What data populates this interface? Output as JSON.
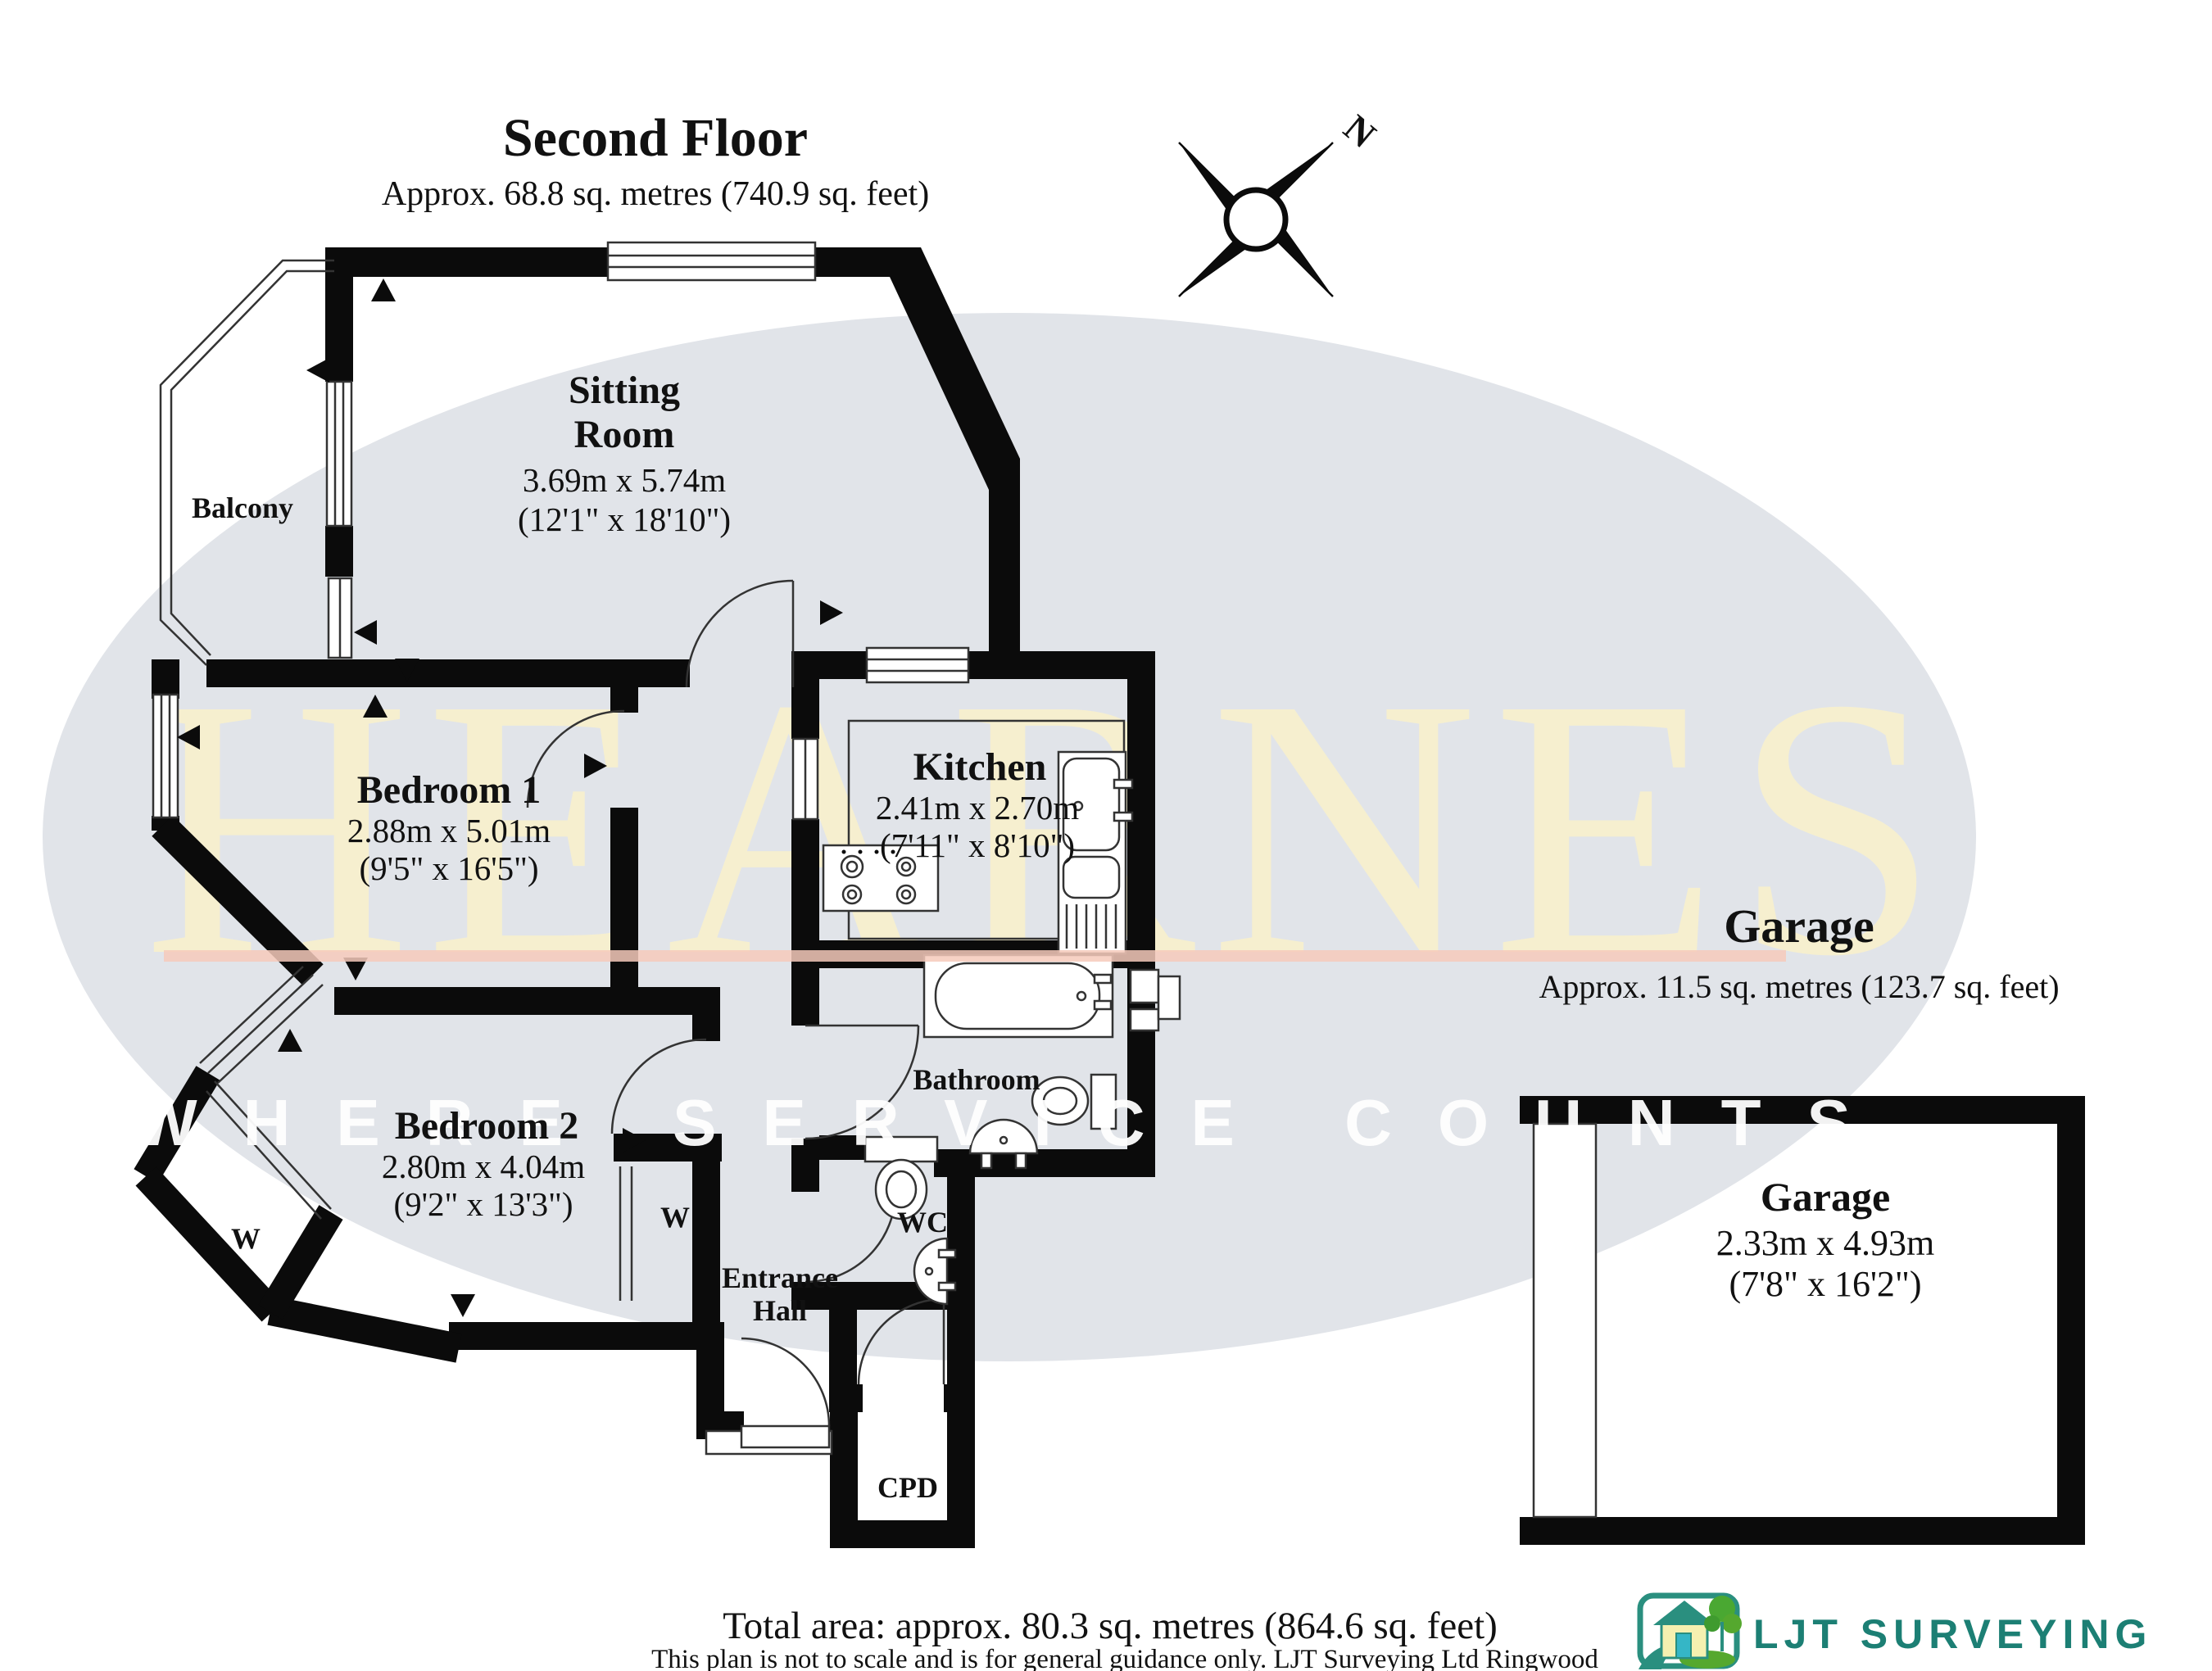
{
  "plan": {
    "title": "Second Floor",
    "subtitle": "Approx. 68.8 sq. metres (740.9 sq. feet)"
  },
  "compass": {
    "north": "N"
  },
  "rooms": {
    "sitting": {
      "line1": "Sitting",
      "line2": "Room",
      "dim_m": "3.69m x 5.74m",
      "dim_ft": "(12'1\" x 18'10\")"
    },
    "balcony": {
      "name": "Balcony"
    },
    "bedroom1": {
      "name": "Bedroom 1",
      "dim_m": "2.88m x 5.01m",
      "dim_ft": "(9'5\" x 16'5\")"
    },
    "kitchen": {
      "name": "Kitchen",
      "dim_m": "2.41m x 2.70m",
      "dim_ft": "(7'11\" x 8'10\")"
    },
    "bedroom2": {
      "name": "Bedroom 2",
      "dim_m": "2.80m x 4.04m",
      "dim_ft": "(9'2\" x 13'3\")"
    },
    "bathroom": {
      "name": "Bathroom"
    },
    "wc": {
      "name": "WC"
    },
    "entrance": {
      "line1": "Entrance",
      "line2": "Hall"
    },
    "cpd": {
      "name": "CPD"
    },
    "closet_bedroom2": {
      "name": "W"
    },
    "closet_hall": {
      "name": "W"
    }
  },
  "garage": {
    "heading": "Garage",
    "heading_area": "Approx. 11.5 sq. metres (123.7 sq. feet)",
    "name": "Garage",
    "dim_m": "2.33m x 4.93m",
    "dim_ft": "(7'8\" x 16'2\")"
  },
  "watermark": {
    "brand": "HEARNES",
    "tagline": "WHERE SERVICE COUNTS",
    "ellipse_color": "#e1e4e9",
    "brand_color": "#f8f1cd",
    "underline_color": "#f6cabb"
  },
  "footer": {
    "total_area": "Total area: approx. 80.3 sq. metres (864.6 sq. feet)",
    "disclaimer": "This plan is not to scale and is for general guidance only. LJT Surveying Ltd Ringwood"
  },
  "logo": {
    "name": "LJT Surveying",
    "accent": "#1c7f74"
  }
}
